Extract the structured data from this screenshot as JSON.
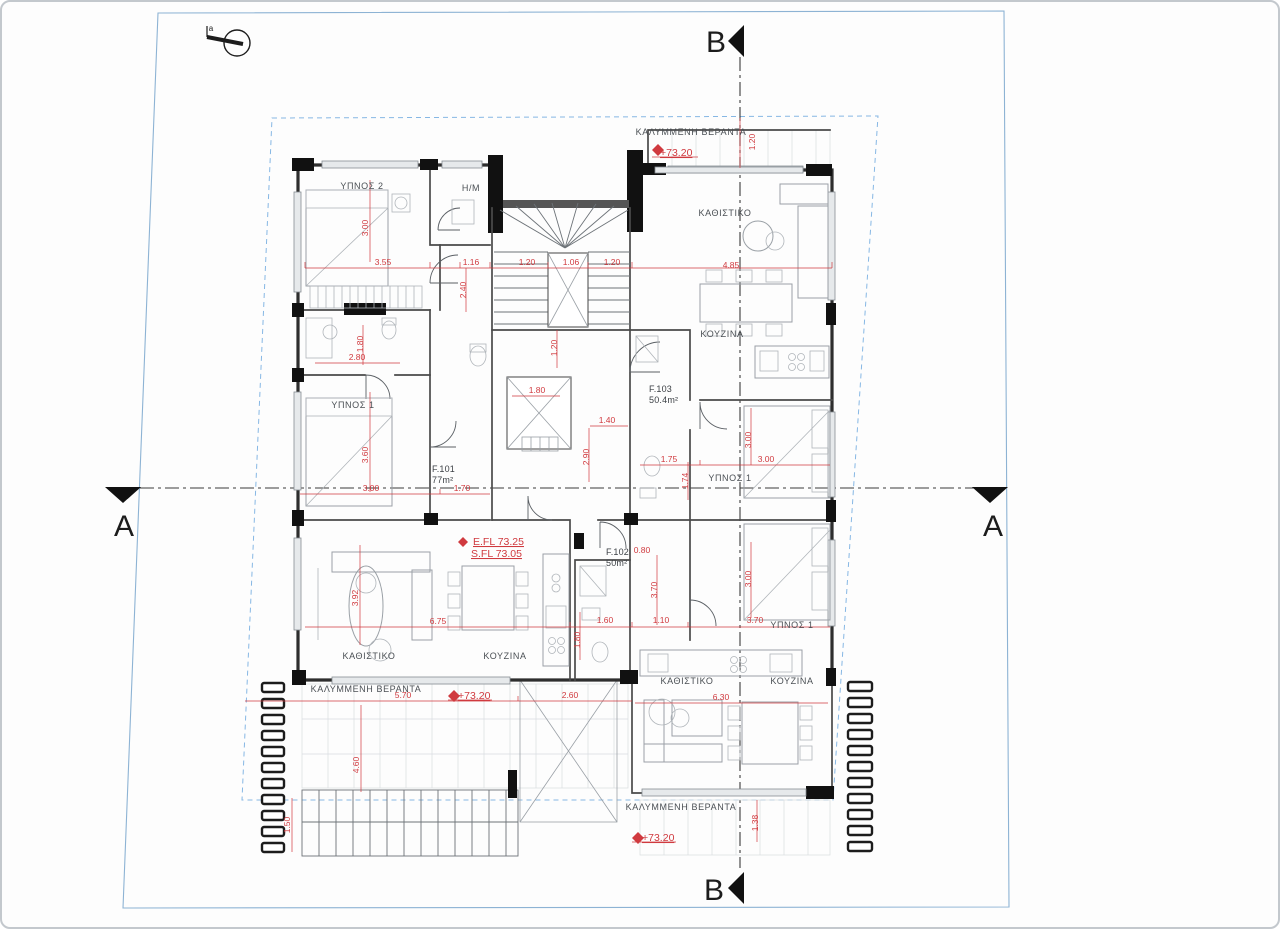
{
  "drawing": {
    "type": "architectural-floor-plan",
    "north_label": "a",
    "sections": {
      "top": "B",
      "bottom": "B",
      "left": "A",
      "right": "A"
    },
    "apartments": [
      {
        "id": "F.101",
        "area": "77m²"
      },
      {
        "id": "F.102",
        "area": "50m²"
      },
      {
        "id": "F.103",
        "area": "50.4m²"
      }
    ],
    "levels": {
      "entrance_floor": "E.FL 73.25",
      "structural_floor": "S.FL 73.05",
      "veranda_level": "+73.20"
    },
    "colors": {
      "dimension_red": "#d03a3f",
      "boundary_blue": "#86b7e4",
      "wall_black": "#2e2e2e"
    }
  },
  "room_labels": [
    {
      "text": "ΥΠΝΟΣ 2",
      "x": 362,
      "y": 189
    },
    {
      "text": "H/M",
      "x": 471,
      "y": 191
    },
    {
      "text": "ΚΑΘΙΣΤΙΚΟ",
      "x": 725,
      "y": 216
    },
    {
      "text": "ΚΟΥΖΙΝΑ",
      "x": 722,
      "y": 337
    },
    {
      "text": "ΥΠΝΟΣ 1",
      "x": 353,
      "y": 408
    },
    {
      "text": "ΥΠΝΟΣ 1",
      "x": 730,
      "y": 481
    },
    {
      "text": "ΚΑΘΙΣΤΙΚΟ",
      "x": 369,
      "y": 659
    },
    {
      "text": "ΚΟΥΖΙΝΑ",
      "x": 505,
      "y": 659
    },
    {
      "text": "ΥΠΝΟΣ 1",
      "x": 792,
      "y": 628
    },
    {
      "text": "ΚΑΘΙΣΤΙΚΟ",
      "x": 687,
      "y": 684
    },
    {
      "text": "ΚΟΥΖΙΝΑ",
      "x": 792,
      "y": 684
    },
    {
      "text": "ΚΑΛΥΜΜΕΝΗ ΒΕΡΑΝΤΑ",
      "x": 691,
      "y": 135
    },
    {
      "text": "ΚΑΛΥΜΜΕΝΗ ΒΕΡΑΝΤΑ",
      "x": 366,
      "y": 692
    },
    {
      "text": "ΚΑΛΥΜΜΕΝΗ ΒΕΡΑΝΤΑ",
      "x": 681,
      "y": 810
    }
  ],
  "apartment_labels": [
    {
      "text": "F.101",
      "x": 432,
      "y": 472
    },
    {
      "text": "77m²",
      "x": 432,
      "y": 483
    },
    {
      "text": "F.103",
      "x": 649,
      "y": 392
    },
    {
      "text": "50.4m²",
      "x": 649,
      "y": 403
    },
    {
      "text": "F.102",
      "x": 606,
      "y": 555
    },
    {
      "text": "50m²",
      "x": 606,
      "y": 566
    }
  ],
  "red_labels": [
    {
      "text": "+73.20",
      "x": 660,
      "y": 156
    },
    {
      "text": "+73.20",
      "x": 458,
      "y": 699
    },
    {
      "text": "+73.20",
      "x": 642,
      "y": 841
    },
    {
      "text": "E.FL 73.25",
      "x": 473,
      "y": 545
    },
    {
      "text": "S.FL 73.05",
      "x": 471,
      "y": 557
    }
  ],
  "dim_labels": [
    {
      "text": "3.55",
      "x": 383,
      "y": 265
    },
    {
      "text": "1.16",
      "x": 471,
      "y": 265
    },
    {
      "text": "1.20",
      "x": 527,
      "y": 265
    },
    {
      "text": "1.06",
      "x": 571,
      "y": 265
    },
    {
      "text": "1.20",
      "x": 612,
      "y": 265
    },
    {
      "text": "4.85",
      "x": 731,
      "y": 268
    },
    {
      "text": "2.80",
      "x": 357,
      "y": 360
    },
    {
      "text": "1.80",
      "x": 537,
      "y": 393
    },
    {
      "text": "1.40",
      "x": 607,
      "y": 423
    },
    {
      "text": "1.75",
      "x": 669,
      "y": 462
    },
    {
      "text": "3.00",
      "x": 766,
      "y": 462
    },
    {
      "text": "3.00",
      "x": 371,
      "y": 491
    },
    {
      "text": "1.70",
      "x": 462,
      "y": 491
    },
    {
      "text": "0.80",
      "x": 642,
      "y": 553
    },
    {
      "text": "6.75",
      "x": 438,
      "y": 624
    },
    {
      "text": "1.60",
      "x": 605,
      "y": 623
    },
    {
      "text": "1.10",
      "x": 661,
      "y": 623
    },
    {
      "text": "3.70",
      "x": 755,
      "y": 623
    },
    {
      "text": "5.70",
      "x": 403,
      "y": 698
    },
    {
      "text": "2.60",
      "x": 570,
      "y": 698
    },
    {
      "text": "6.30",
      "x": 721,
      "y": 700
    },
    {
      "text": "3.00",
      "x": 368,
      "y": 228,
      "rot": -90
    },
    {
      "text": "2.40",
      "x": 466,
      "y": 290,
      "rot": -90
    },
    {
      "text": "1.20",
      "x": 755,
      "y": 142,
      "rot": -90
    },
    {
      "text": "1.80",
      "x": 363,
      "y": 344,
      "rot": -90
    },
    {
      "text": "3.60",
      "x": 368,
      "y": 455,
      "rot": -90
    },
    {
      "text": "1.20",
      "x": 557,
      "y": 348,
      "rot": -90
    },
    {
      "text": "2.90",
      "x": 589,
      "y": 457,
      "rot": -90
    },
    {
      "text": "3.00",
      "x": 751,
      "y": 440,
      "rot": -90
    },
    {
      "text": "1.74",
      "x": 688,
      "y": 481,
      "rot": -90
    },
    {
      "text": "3.92",
      "x": 358,
      "y": 598,
      "rot": -90
    },
    {
      "text": "3.00",
      "x": 751,
      "y": 579,
      "rot": -90
    },
    {
      "text": "3.70",
      "x": 657,
      "y": 590,
      "rot": -90
    },
    {
      "text": "1.80",
      "x": 580,
      "y": 640,
      "rot": -90
    },
    {
      "text": "4.60",
      "x": 359,
      "y": 765,
      "rot": -90
    },
    {
      "text": "1.38",
      "x": 758,
      "y": 823,
      "rot": -90
    },
    {
      "text": "1.50",
      "x": 290,
      "y": 825,
      "rot": -90
    }
  ]
}
